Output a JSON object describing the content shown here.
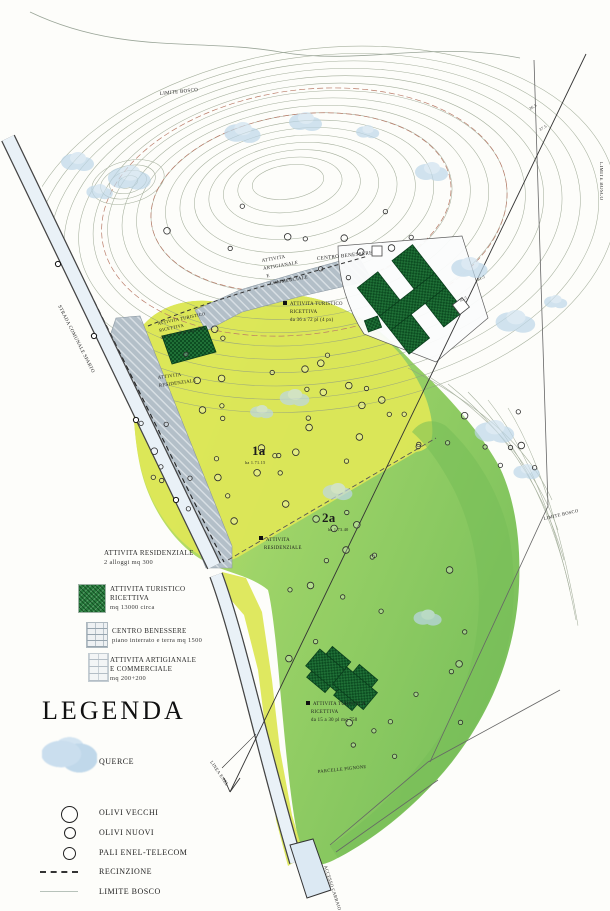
{
  "doc": {
    "type": "piano urbanistico / site plan",
    "title": "LEGENDA"
  },
  "legend": {
    "title": "LEGENDA",
    "items": [
      {
        "id": "attivita-residenziale",
        "lines": [
          "ATTIVITA RESIDENZIALE",
          "2 alloggi mq 300"
        ]
      },
      {
        "id": "attivita-turistico-ricettiva",
        "swatch": "green-texture",
        "lines": [
          "ATTIVITA TURISTICO",
          "RICETTIVA",
          "mq 13000 circa"
        ]
      },
      {
        "id": "centro-benessere",
        "swatch": "gray-brick",
        "lines": [
          "CENTRO BENESSERE",
          "piano interrato e terra mq 1500"
        ]
      },
      {
        "id": "attivita-artigianale",
        "swatch": "light-brick",
        "lines": [
          "ATTIVITA ARTIGIANALE",
          "E COMMERCIALE",
          "mq 200+200"
        ]
      },
      {
        "id": "querce",
        "swatch": "blue-blob",
        "label": "QUERCE"
      },
      {
        "id": "olivi-vecchi",
        "swatch": "circle-large",
        "label": "OLIVI VECCHI"
      },
      {
        "id": "olivi-nuovi",
        "swatch": "circle-medium",
        "label": "OLIVI NUOVI"
      },
      {
        "id": "pali-enel-telecom",
        "swatch": "circle-small",
        "label": "PALI ENEL-TELECOM"
      },
      {
        "id": "recinzione",
        "swatch": "dashed-line",
        "label": "RECINZIONE"
      },
      {
        "id": "limite-bosco",
        "swatch": "thin-line",
        "label": "LIMITE BOSCO"
      }
    ]
  },
  "map_labels": {
    "limite_bosco_top": "LIMITE BOSCO",
    "limite_bosco_edge": "LIMITE BOSCO",
    "limite_bosco_right": "LIMITE BOSCO",
    "strada_comunale": "STRADA COMUNALE SPARTO",
    "linea_enel": "LINEA ENEL",
    "parcelle": "PARCELLE PIGNONE",
    "accesso": "ACCESSO CARRAIO",
    "centro_benessere": "CENTRO BENESSERE",
    "artigianale": [
      "ATTIVITA",
      "ARTIGIANALE",
      "E",
      "COMMERCIALE"
    ],
    "turistico_ne": [
      "ATTIVITA TURISTICO",
      "RICETTIVA",
      "da 36 a 72 pl (4 px)"
    ],
    "turistico_w": [
      "ATTIVITA TURISTICO",
      "RICETTIVA",
      "da 15 a 30 pl mq 1150"
    ],
    "residenziale_w": [
      "ATTIVITA",
      "RESIDENZIALE"
    ],
    "residenziale_c": [
      "ATTIVITA",
      "RESIDENZIALE"
    ],
    "turistica_s": [
      "ATTIVITA TURISTICA",
      "RICETTIVA",
      "da 15 a 30 pl mq 750"
    ]
  },
  "zones": {
    "zone1": {
      "id": "1a",
      "area": "ha 1.71.15"
    },
    "zone2": {
      "id": "2a",
      "area": "ha 1.73.40"
    }
  },
  "elevations": [
    "36.5",
    "37.5",
    "31.5",
    "30.5"
  ],
  "colors": {
    "zone_yellow": "#dde757",
    "zone_green": "#9ed468",
    "zone_dark_green": "#76bd58",
    "building_green": "#1f7036",
    "road_fill": "#e9f1f7",
    "hatch_gray": "#b3bfc8",
    "tree_blue": "#bcd6e8",
    "contour": "#8f9c85"
  }
}
